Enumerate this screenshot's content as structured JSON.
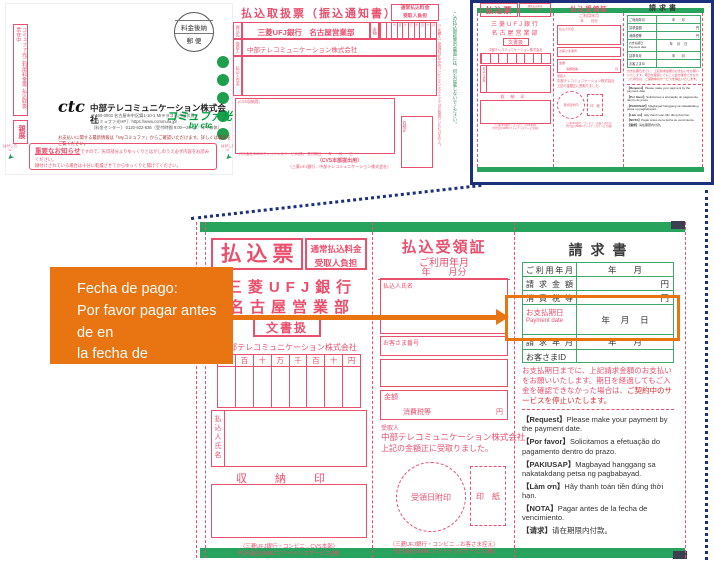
{
  "envelope": {
    "side_label": "コミュファ光ご利用料金等 払込取扱票在中",
    "confidential": "親展",
    "postmark_top": "料金後納",
    "postmark_bottom": "郵 便",
    "logo": "ctc",
    "company": "中部テレコミュニケーション株式会社",
    "address1": "〒460-0003 名古屋市中区錦1-10-1 MIテラス名古屋伏見",
    "address2": "［コミュファ光HP］ https://www.commufa.jp/",
    "address3": "［料金センター］ 0120-922-636（受付時間 9:00〜20:00／年中無休）",
    "myinfo": "お支払いに関する最新情報は「Myコミュファ」からご確認いただけます。詳しくは裏面をご覧ください。",
    "brand": "コミュファ光",
    "brand_by": "by ctc",
    "notice_title": "重要なお知らせ",
    "notice_text1": "ですので、矢印部分よりゆっくりとはがしのうえ必ず内容をお読みください。",
    "notice_text2": "糊付けされている場合は十分に乾燥させてからゆっくりと開けてください。",
    "peel1": "はがし方①",
    "peel2": "はがし方②"
  },
  "handling_slip": {
    "title": "払込取扱票（振込通知書）",
    "fee1": "通常払込料金",
    "fee2": "受取人負担",
    "label_bank": "振込先",
    "label_payee": "受取人",
    "label_payer": "払込人氏名",
    "bank": "三菱UFJ銀行　名古屋営業部",
    "amount": "金額",
    "payee": "中部テレコミュニケーション株式会社",
    "cvs": "(CVS収納用)",
    "stamp": "収納印",
    "side_note": "（ご依頼人）受領証は払込みコンビニエンスストアではお取扱いいただけません。",
    "back_note": "この払込取扱票の裏面には、何も記載しないでください。",
    "meta": "代行会社SMBCファイナンスサービス(株)　受付期日　　年　　月　　日",
    "footer1": "（CVS本部提出用）",
    "footer2": "（三菱UFJ銀行→中部テレコミュニケーション株式会社）"
  },
  "slip": {
    "col1": {
      "title": "払込票",
      "fee1": "通常払込料金",
      "fee2": "受取人負担",
      "bank1": "三菱UFJ銀行",
      "bank2": "名古屋営業部",
      "doc": "文書扱",
      "payee": "中部テレコミュニケーション株式会社",
      "digits": [
        "千",
        "百",
        "十",
        "万",
        "千",
        "百",
        "十",
        "円"
      ],
      "payer": "払込人氏名",
      "stamp": "収納印",
      "footer1": "（三菱UFJ銀行・コンビニ→CVS本部）",
      "footer2": "代行会社SMBCファイナンスサービス(株)"
    },
    "col2": {
      "title": "払込受領証",
      "sub1": "ご利用年月",
      "sub2": "年　　月分",
      "payer": "払込人氏名",
      "customer": "お客さま番号",
      "amount": "金額",
      "tax": "消費税等",
      "yen": "円",
      "recipient_label": "受取人",
      "recipient": "中部テレコミュニケーション株式会社",
      "received": "上記の金額正に受取りました。",
      "stamp_circle": "受領日附印",
      "stamp_rect": "印　紙",
      "footer1": "（三菱UFJ銀行・コンビニ→お客さま控え）",
      "footer2": "代行会社SMBCファイナンスサービス(株)"
    },
    "col3": {
      "title": "請求書",
      "rows": [
        {
          "label": "ご利用年月",
          "value": "年　　月"
        },
        {
          "label": "請求金額",
          "value": "円"
        },
        {
          "label": "消費税等",
          "value": "円"
        },
        {
          "label": "お支払期日",
          "sublabel": "Payment date",
          "value": "年　 月　 日"
        },
        {
          "label": "請求年月",
          "value": "年　　月"
        },
        {
          "label": "お客さまID",
          "value": ""
        }
      ],
      "notice1": "お支払期日までに、上記請求金額のお支払いをお願いいたします。",
      "notice2": "期日を経過してもご入金を確認できなかった場合は、",
      "notice_em": "ご契約中のサービスを停止いたします。",
      "translations": [
        {
          "tag": "【Request】",
          "text": "Please make your payment by the payment date."
        },
        {
          "tag": "【Por favor】",
          "text": "Solicitamos a efetuação do pagamento dentro do prazo."
        },
        {
          "tag": "【PAKIUSAP】",
          "text": "Magbayad hanggang sa nakatakdang petsa ng pagbabayad."
        },
        {
          "tag": "【Làm ơn】",
          "text": "Hãy thanh toán tiền đúng thời hạn."
        },
        {
          "tag": "【NOTA】",
          "text": "Pagar antes de la fecha de vencimiento."
        },
        {
          "tag": "【请求】",
          "text": "请在期限内付款。"
        }
      ]
    }
  },
  "callout": {
    "line1": "Fecha de pago:",
    "line2": "Por favor pagar antes de en",
    "line3": "la fecha de vencimiento."
  },
  "colors": {
    "slip_red": "#e8506e",
    "band_green": "#27a35d",
    "frame_navy": "#1b2f7d",
    "accent_orange": "#e87511"
  }
}
